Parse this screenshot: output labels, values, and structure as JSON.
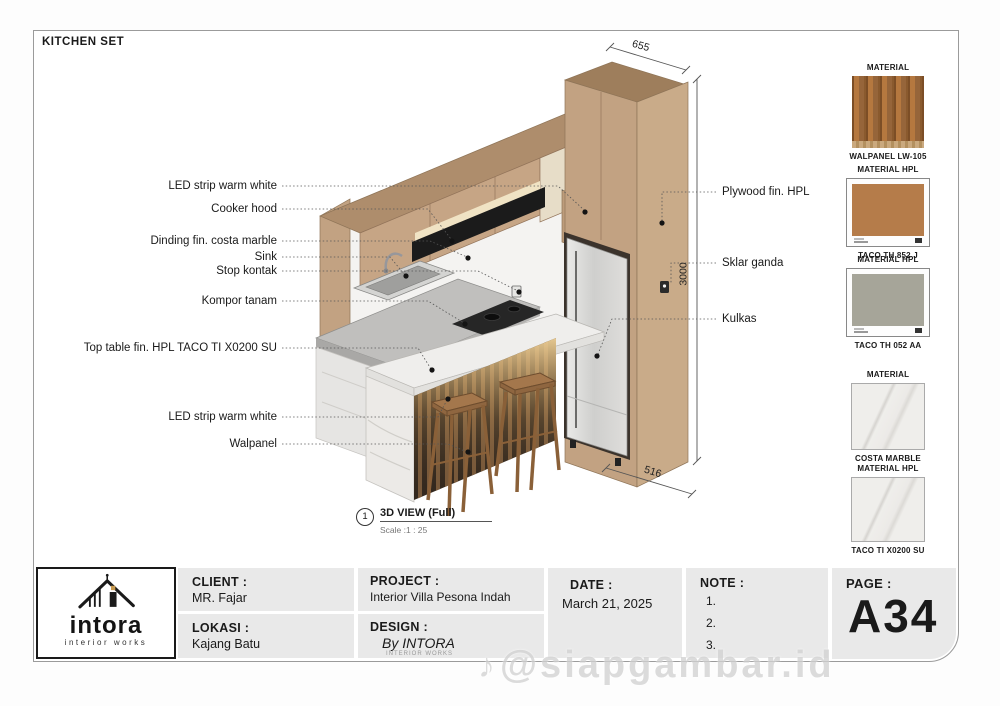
{
  "sheet": {
    "title": "KITCHEN SET",
    "view": {
      "number": "1",
      "label": "3D VIEW (Full)",
      "scale": "Scale :1 : 25"
    },
    "watermark": {
      "icon": "♪",
      "text": "@siapgambar.id"
    }
  },
  "dimensions": {
    "top": "655",
    "right": "3000",
    "bottom": "516"
  },
  "annotations": {
    "left": [
      "LED strip warm white",
      "Cooker hood",
      "Dinding fin. costa marble",
      "Sink",
      "Stop kontak",
      "Kompor tanam",
      "Top table fin. HPL TACO TI X0200 SU",
      "LED strip warm white",
      "Walpanel"
    ],
    "right": [
      "Plywood fin. HPL",
      "Sklar ganda",
      "Kulkas"
    ]
  },
  "materials": [
    {
      "header": "MATERIAL",
      "label": "WALPANEL LW-105",
      "swatch": "wood-slat-panel"
    },
    {
      "header": "MATERIAL HPL",
      "label": "TACO TH 852 J",
      "swatch": "tan-hpl"
    },
    {
      "header": "MATERIAL HPL",
      "label": "TACO TH 052 AA",
      "swatch": "gray-hpl"
    },
    {
      "header": "MATERIAL",
      "label": "COSTA MARBLE",
      "swatch": "white-marble"
    },
    {
      "header": "MATERIAL HPL",
      "label": "TACO TI X0200 SU",
      "swatch": "white-marble"
    }
  ],
  "title_block": {
    "logo": {
      "name": "intora",
      "tagline": "interior works"
    },
    "client_label": "CLIENT :",
    "client": "MR. Fajar",
    "lokasi_label": "LOKASI :",
    "lokasi": "Kajang Batu",
    "project_label": "PROJECT :",
    "project": "Interior Villa Pesona Indah",
    "design_label": "DESIGN :",
    "design": "By INTORA",
    "design_sub": "INTERIOR WORKS",
    "date_label": "DATE :",
    "date": "March 21, 2025",
    "note_label": "NOTE :",
    "notes": [
      "1.",
      "2.",
      "3."
    ],
    "page_label": "PAGE :",
    "page": "A34"
  },
  "colors": {
    "cabinet_tan": "#c2a282",
    "marble": "#efeeec",
    "led_warm": "#eecf96",
    "logo_accent": "#c89a4e"
  }
}
